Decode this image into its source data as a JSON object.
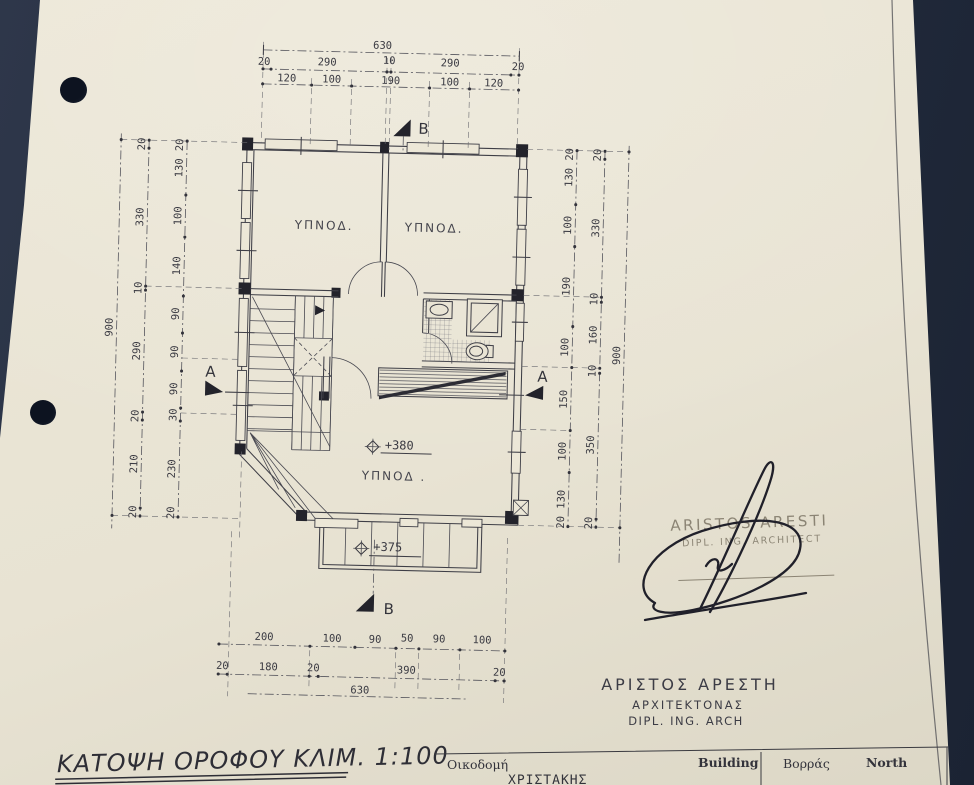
{
  "meta": {
    "background": "#252e40",
    "paper": "#e8e3d3",
    "ink": "#3a3a42"
  },
  "title": {
    "text": "ΚΑΤΟΨΗ ΟΡΟΦΟΥ ΚΛΙΜ. 1:100"
  },
  "plan": {
    "room_labels": [
      "ΥΠΝΟΔ.",
      "ΥΠΝΟΔ.",
      "ΥΠΝΟΔ ."
    ],
    "levels": {
      "floor": "+380",
      "balcony": "+375"
    },
    "sections": {
      "a": "A",
      "b": "B"
    }
  },
  "dims": {
    "top": {
      "total": "630",
      "chain1": [
        "20",
        "290",
        "10",
        "290",
        "20"
      ],
      "chain2": [
        "120",
        "100",
        "190",
        "100",
        "120"
      ]
    },
    "bottom": {
      "chain1": [
        "200",
        "100",
        "90",
        "50",
        "90",
        "100"
      ],
      "chain2": [
        "20",
        "180",
        "20",
        "390",
        "20"
      ],
      "total": "630"
    },
    "left": {
      "total": "900",
      "mid": [
        "20",
        "330",
        "10",
        "290",
        "20",
        "210",
        "20"
      ],
      "inner": [
        "20",
        "130",
        "100",
        "140",
        "90",
        "90",
        "90",
        "30",
        "230",
        "20"
      ]
    },
    "right": {
      "total": "900",
      "mid": [
        "20",
        "330",
        "10",
        "160",
        "10",
        "350",
        "20"
      ],
      "inner": [
        "20",
        "130",
        "100",
        "190",
        "100",
        "150",
        "100",
        "130",
        "20"
      ]
    }
  },
  "stamp": {
    "name": "ARISTOS ARESTI",
    "role": "DIPL. ING. ARCHITECT"
  },
  "architect": {
    "name": "ΑΡΙΣΤΟΣ  ΑΡΕΣΤΗ",
    "role": "ΑΡΧΙΤΕΚΤΟΝΑΣ",
    "degree": "DIPL. ING. ARCH"
  },
  "titleblock": {
    "building_gr": "Οικοδομή",
    "building_en": "Building",
    "owner": "ΧΡΙΣΤΑΚΗΣ",
    "north_gr": "Βορράς",
    "north_en": "North"
  }
}
